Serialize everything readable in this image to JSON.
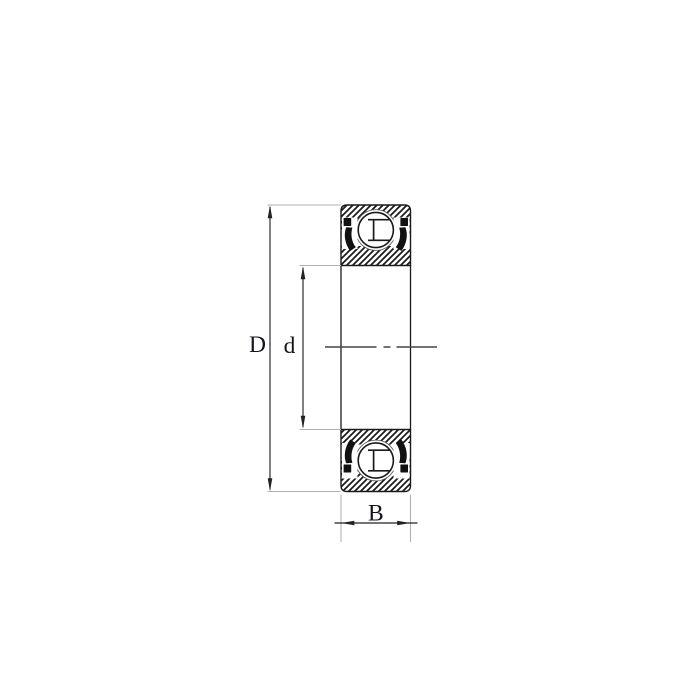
{
  "diagram": {
    "type": "deep-groove-ball-bearing-cross-section",
    "dimension_labels": {
      "outer_diameter": "D",
      "bore_diameter": "d",
      "width": "B"
    },
    "colors": {
      "background": "#ffffff",
      "line": "#1a1a1a",
      "seal": "#111111",
      "raceway_edge": "#555555",
      "extension_line": "#b3b3b3",
      "centerline": "#474747",
      "dimension_line": "#222222",
      "label_text": "#14141c"
    }
  }
}
